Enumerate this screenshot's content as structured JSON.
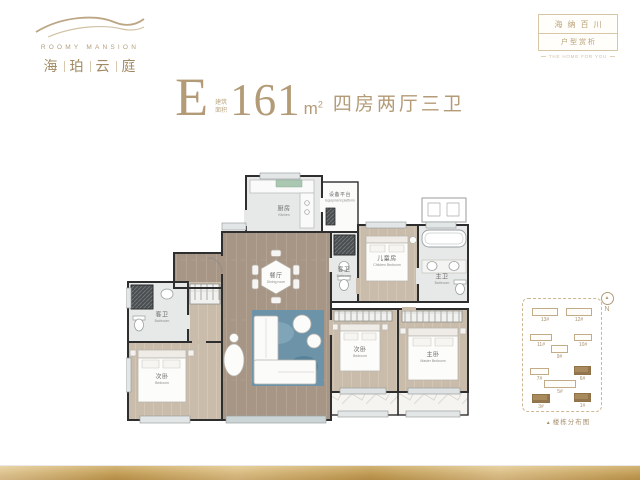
{
  "logo": {
    "en": "ROOMY MANSION",
    "chars": [
      "海",
      "珀",
      "云",
      "庭"
    ]
  },
  "badge": {
    "line1": "海纳百川",
    "line2": "户型赏析",
    "tagline": "THE HOME FOR YOU"
  },
  "title": {
    "unit": "E",
    "note1": "建筑",
    "note2": "面积",
    "area": "161",
    "unit_m": "m",
    "unit_exp": "2",
    "desc": "四房两厅三卫"
  },
  "floorplan": {
    "rooms": [
      {
        "cn": "厨房",
        "en": "Kitchen"
      },
      {
        "cn": "设备平台",
        "en": "Equipment platform"
      },
      {
        "cn": "餐厅",
        "en": "Dining room"
      },
      {
        "cn": "客卫",
        "en": "Bathroom"
      },
      {
        "cn": "客卫",
        "en": "Bathroom"
      },
      {
        "cn": "主卫",
        "en": "Bathroom"
      },
      {
        "cn": "儿童房",
        "en": "Children Bedroom"
      },
      {
        "cn": "次卧",
        "en": "Bedroom"
      },
      {
        "cn": "次卧",
        "en": "Bedroom"
      },
      {
        "cn": "主卧",
        "en": "Master Bedroom"
      }
    ]
  },
  "keyplan": {
    "marker": "▲",
    "caption": "楼栋分布图",
    "compass_n": "N",
    "buildings": [
      {
        "label": "13#",
        "filled": false
      },
      {
        "label": "12#",
        "filled": false
      },
      {
        "label": "11#",
        "filled": false
      },
      {
        "label": "10#",
        "filled": false
      },
      {
        "label": "9#",
        "filled": false
      },
      {
        "label": "7#",
        "filled": false
      },
      {
        "label": "6#",
        "filled": true
      },
      {
        "label": "5#",
        "filled": false
      },
      {
        "label": "3#",
        "filled": true
      },
      {
        "label": "1#",
        "filled": true
      }
    ]
  },
  "colors": {
    "accent_gold": "#b49b77",
    "wall": "#2e2e2e",
    "wood_floor": "#a79685",
    "rug_blue": "#6d93a9",
    "footer_gold": "#cda75e"
  }
}
